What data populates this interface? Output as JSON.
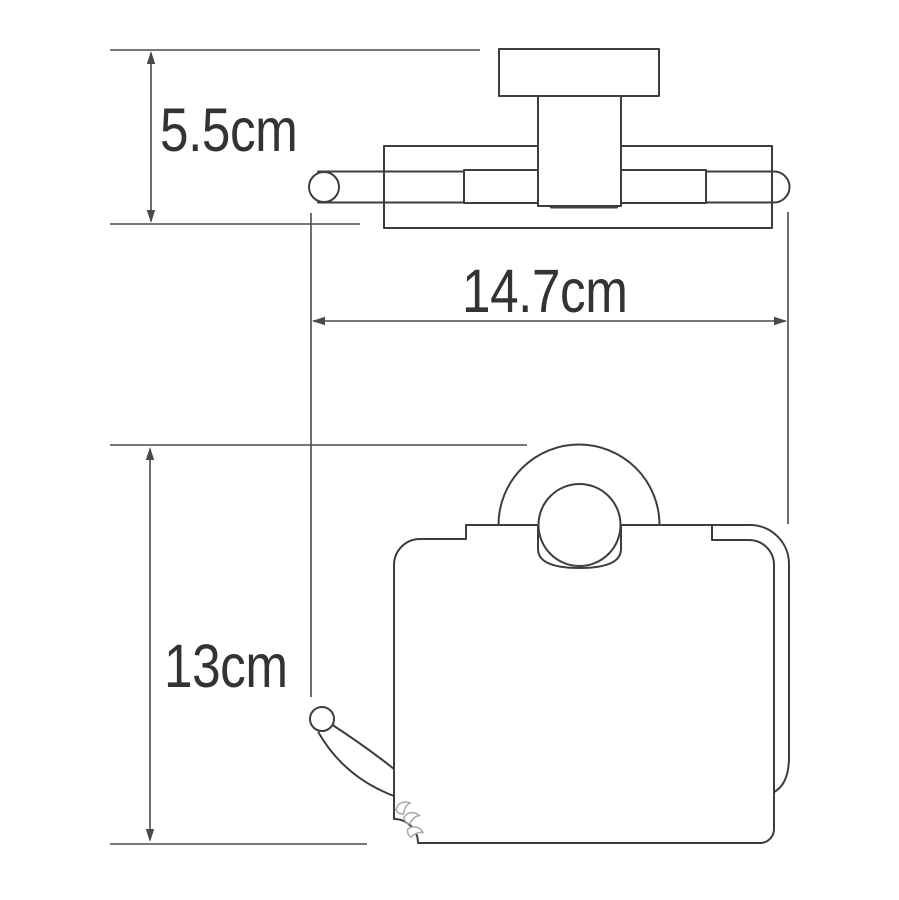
{
  "drawing": {
    "type": "technical-dimension-drawing",
    "subject": "wall-mounted toilet paper holder with cover",
    "background": "#ffffff",
    "stroke_color": "#3d3d3d",
    "dimension_line_color": "#4a4a4a",
    "label_color": "#333333",
    "views": [
      {
        "name": "top-view",
        "description": "wall bracket, mounting plate and roller bar seen from above"
      },
      {
        "name": "front-view",
        "description": "holder body with cover, mounting ring and spindle hook seen from front"
      }
    ],
    "dimensions": [
      {
        "id": "bracket-depth",
        "label": "5.5cm",
        "orientation": "vertical",
        "applies_to": "top view: bracket depth from wall plate to roller bar"
      },
      {
        "id": "overall-width",
        "label": "14.7cm",
        "orientation": "horizontal",
        "applies_to": "top view: overall roller bar width"
      },
      {
        "id": "overall-height",
        "label": "13cm",
        "orientation": "vertical",
        "applies_to": "front view: overall holder height"
      }
    ]
  }
}
